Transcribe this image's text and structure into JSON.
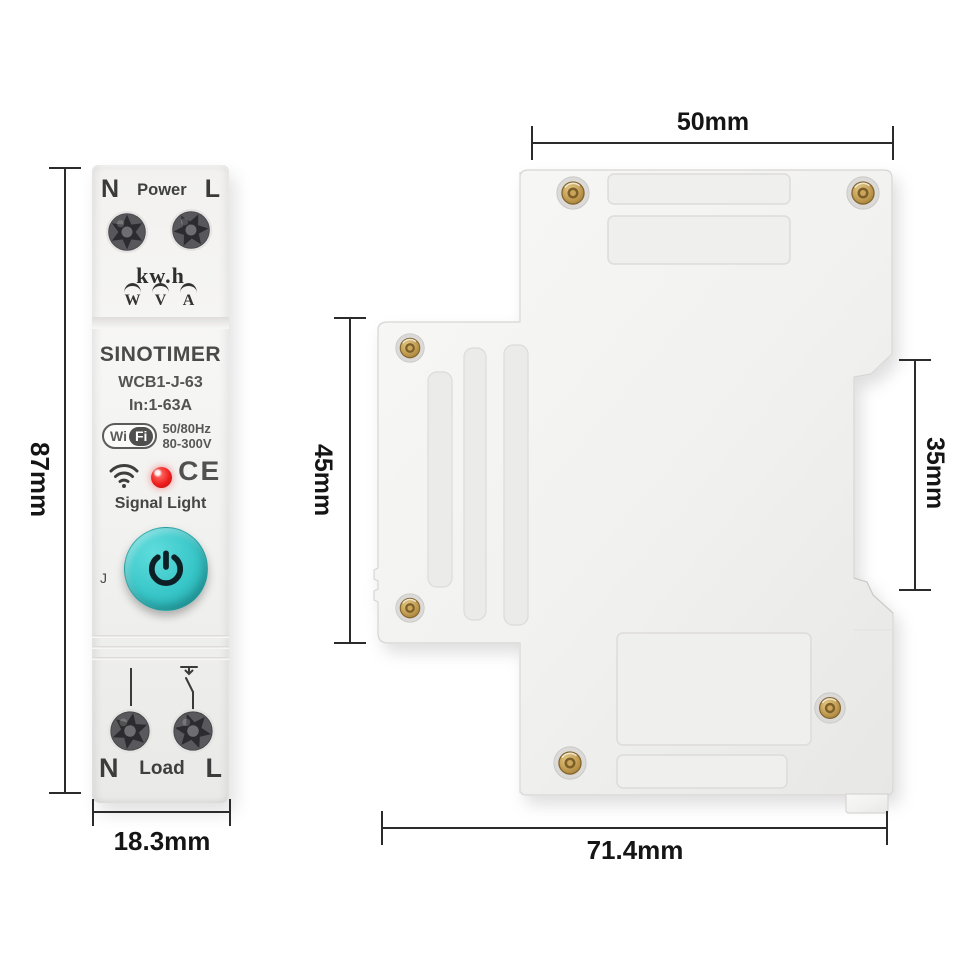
{
  "front_view": {
    "top_terminals": {
      "left": "N",
      "center": "Power",
      "right": "L"
    },
    "meter_unit": "kw.h",
    "meter_symbols": [
      "W",
      "V",
      "A"
    ],
    "brand": "SINOTIMER",
    "model": "WCB1-J-63",
    "current_range": "In:1-63A",
    "wifi_badge": {
      "wi": "Wi",
      "fi": "Fi"
    },
    "frequency": "50/80Hz",
    "voltage": "80-300V",
    "ce_mark": "CE",
    "signal_label": "Signal Light",
    "j_label": "J",
    "bottom_terminals": {
      "left": "N",
      "center": "Load",
      "right": "L"
    }
  },
  "dimensions": {
    "front_height": "87mm",
    "front_width": "18.3mm",
    "side_top_width": "50mm",
    "side_front_height": "45mm",
    "side_rail_height": "35mm",
    "side_depth": "71.4mm"
  },
  "colors": {
    "power_button": "#35c4c6",
    "led": "#ee1d1d",
    "brass_screw": "#b9964f",
    "dimension_line": "#2b2b2b",
    "body": "#f2f1ef"
  }
}
